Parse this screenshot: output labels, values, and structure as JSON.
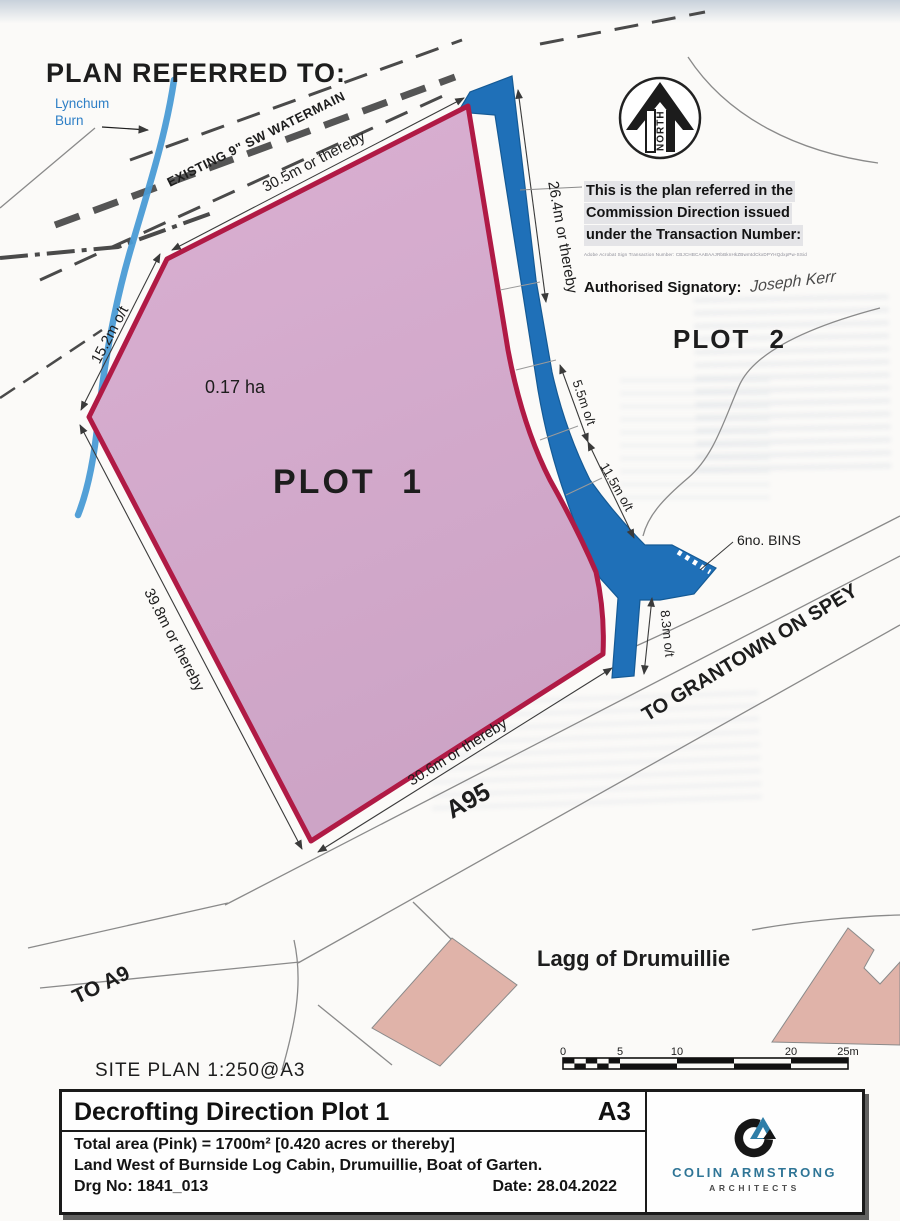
{
  "header": {
    "title": "PLAN REFERRED TO:"
  },
  "map": {
    "stream_label_1": "Lynchum",
    "stream_label_2": "Burn",
    "watermain_label": "EXISTING 9\" SW WATERMAIN",
    "north_label": "NORTH",
    "plot1_label": "PLOT 1",
    "plot1_area": "0.17 ha",
    "plot2_label": "PLOT 2",
    "bins_label": "6no. BINS",
    "settlement_label": "Lagg of Drumuillie",
    "roads": {
      "grantown": "TO GRANTOWN ON SPEY",
      "a95": "A95",
      "a9": "TO A9"
    },
    "dimensions": {
      "top": "30.5m or thereby",
      "upper_left": "15.2m o/t",
      "right": "26.4m or thereby",
      "mid_upper": "5.5m o/t",
      "mid_lower": "11.5m o/t",
      "spur": "8.3m o/t",
      "lower_left": "39.8m or thereby",
      "bottom": "30.6m or thereby"
    }
  },
  "commission_note": {
    "line1": "This is the plan referred in the",
    "line2": "Commission Direction issued",
    "line3": "under the Transaction Number:",
    "transaction": "Adobe Acrobat Sign Transaction Number: CBJCHBCAABAAJRbBknHkZBwmtdCkxDPYHQdxpPw-SSid",
    "signatory_label": "Authorised Signatory:",
    "signature": "Joseph Kerr"
  },
  "site_plan_label": "SITE PLAN  1:250@A3",
  "scale_bar": {
    "ticks": [
      "0",
      "5",
      "10",
      "20",
      "25m"
    ]
  },
  "title_block": {
    "title": "Decrofting Direction Plot 1",
    "sheet": "A3",
    "area_line": "Total area (Pink) = 1700m² [0.420 acres or thereby]",
    "address_line": "Land West of Burnside Log Cabin, Drumuillie, Boat of Garten.",
    "drg_no": "Drg No: 1841_013",
    "date": "Date: 28.04.2022",
    "firm_name": "COLIN ARMSTRONG",
    "firm_subtitle": "ARCHITECTS"
  },
  "colors": {
    "plot_fill": "#d5abcb",
    "plot_border": "#b01a45",
    "access_blue": "#1f70b8",
    "stream_blue": "#4a9bd5",
    "building_fill": "#e0b3a9",
    "brand_teal": "#2f7596"
  }
}
